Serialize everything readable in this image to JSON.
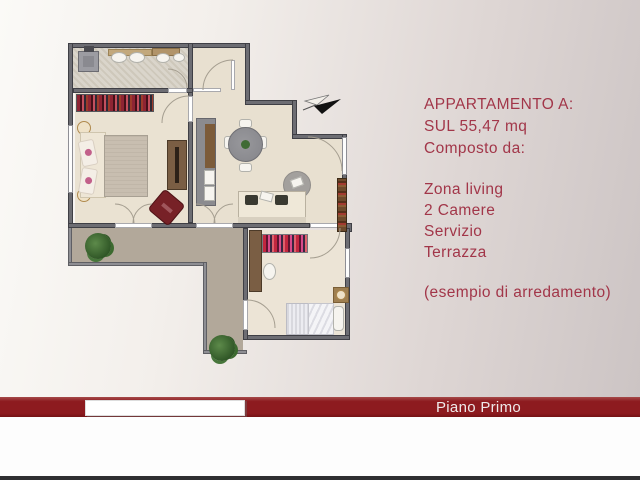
{
  "slide": {
    "background_left": "#fbfaf7",
    "background_right": "#cbc3c3"
  },
  "info_panel": {
    "title": "APPARTAMENTO A:",
    "area_line": "SUL 55,47 mq",
    "composition_label": "Composto da:",
    "features": [
      "Zona living",
      "2 Camere",
      "Servizio",
      "Terrazza"
    ],
    "note": "(esempio di arredamento)",
    "text_color": "#a23649"
  },
  "footer_bar": {
    "label": "Piano Primo",
    "bar_color": "#8d1b1f",
    "label_color": "#efeaea"
  },
  "floorplan": {
    "north_arrow_icon": "north-arrow",
    "wall_color": "#6d6d73",
    "floor_color": "#e8e0d0",
    "terrace_color": "#b2a89a",
    "bathroom_floor_color": "#d8d3c9",
    "accent_red": "#7b2127"
  }
}
